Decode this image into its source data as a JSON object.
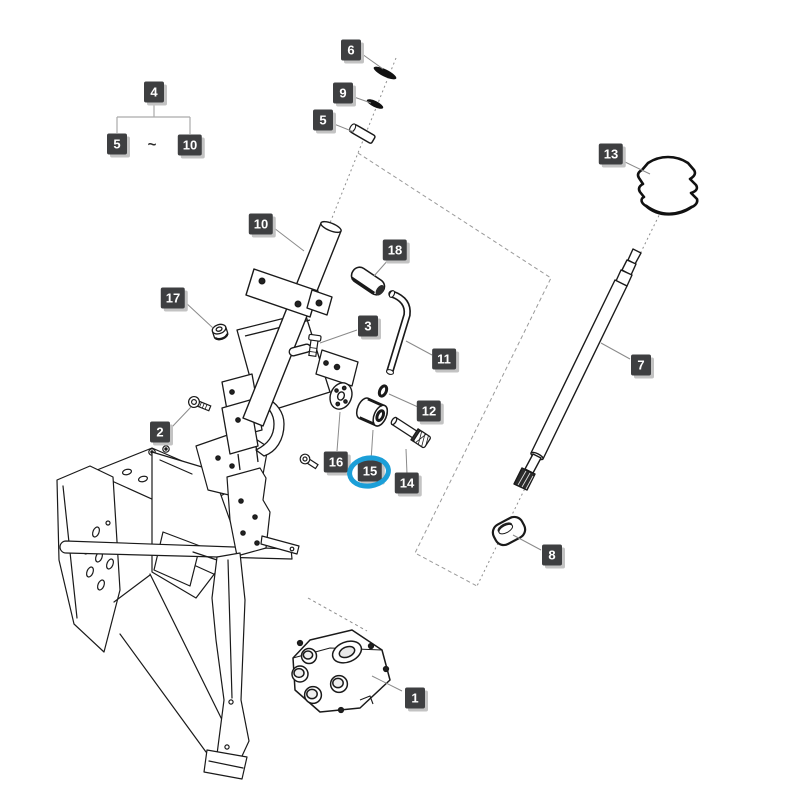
{
  "diagram": {
    "description": "Exploded parts diagram of a tractor steering column assembly",
    "background": "#ffffff",
    "badge_style": {
      "bg": "#3e3f41",
      "text_color": "#ffffff",
      "shadow": "#c3c3c3"
    },
    "highlight": {
      "part": "15",
      "color": "#1b9fd8"
    },
    "part_labels": [
      {
        "text": "1",
        "x": 415,
        "y": 698
      },
      {
        "text": "2",
        "x": 160,
        "y": 432
      },
      {
        "text": "3",
        "x": 368,
        "y": 326
      },
      {
        "text": "5",
        "x": 323,
        "y": 120
      },
      {
        "text": "6",
        "x": 351,
        "y": 50
      },
      {
        "text": "7",
        "x": 641,
        "y": 365
      },
      {
        "text": "8",
        "x": 552,
        "y": 555
      },
      {
        "text": "9",
        "x": 343,
        "y": 93
      },
      {
        "text": "10",
        "x": 261,
        "y": 224
      },
      {
        "text": "11",
        "x": 444,
        "y": 359
      },
      {
        "text": "12",
        "x": 429,
        "y": 411
      },
      {
        "text": "13",
        "x": 611,
        "y": 154
      },
      {
        "text": "14",
        "x": 407,
        "y": 483
      },
      {
        "text": "15",
        "x": 370,
        "y": 471
      },
      {
        "text": "16",
        "x": 336,
        "y": 462
      },
      {
        "text": "17",
        "x": 173,
        "y": 298
      },
      {
        "text": "18",
        "x": 395,
        "y": 250
      }
    ],
    "range_group": {
      "parent": {
        "text": "4",
        "x": 154,
        "y": 92
      },
      "from": {
        "text": "5",
        "x": 117,
        "y": 144
      },
      "to": {
        "text": "10",
        "x": 190,
        "y": 145
      },
      "separator": {
        "text": "~",
        "x": 152,
        "y": 145
      }
    }
  }
}
